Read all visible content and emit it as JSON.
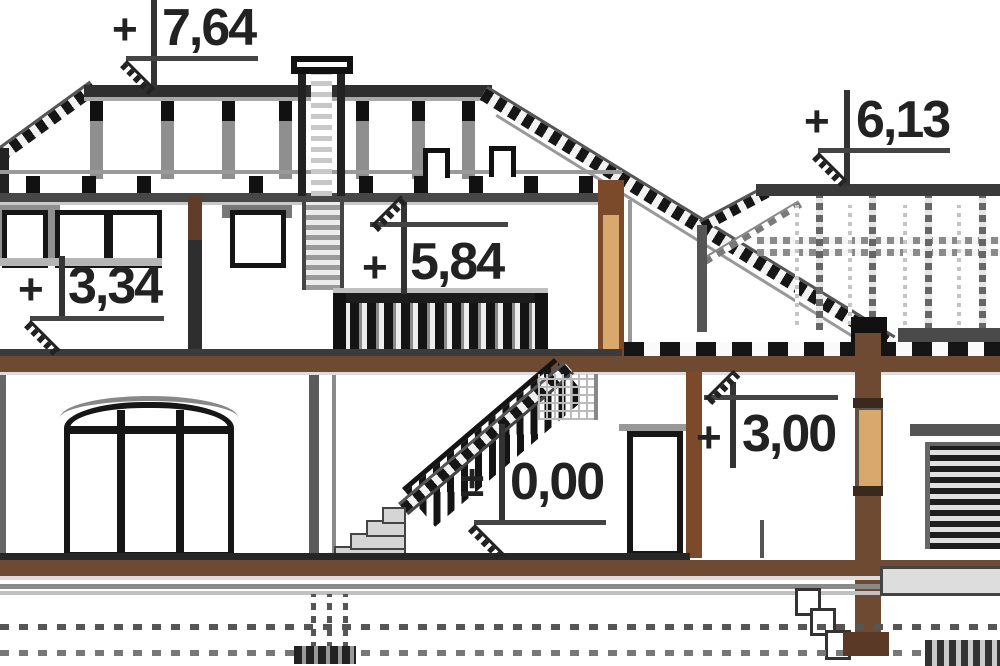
{
  "drawing": {
    "type": "house cross-section, architectural elevation drawing",
    "markers": [
      {
        "id": "ridge",
        "prefix": "+",
        "value": "7,64"
      },
      {
        "id": "wing-roof",
        "prefix": "+",
        "value": "6,13"
      },
      {
        "id": "attic-knee",
        "prefix": "+",
        "value": "3,34"
      },
      {
        "id": "collar-beam",
        "prefix": "+",
        "value": "5,84"
      },
      {
        "id": "ground-floor",
        "prefix": "±",
        "value": "0,00"
      },
      {
        "id": "wing-floor",
        "prefix": "+",
        "value": "3,00"
      }
    ],
    "colors": {
      "wood_slab_brown": "#6e4a32",
      "wood_frame_brown": "#7a4a2b",
      "panel_tan": "#d9a86c",
      "line_dark": "#1a1a1a",
      "line_gray": "#888888"
    }
  }
}
